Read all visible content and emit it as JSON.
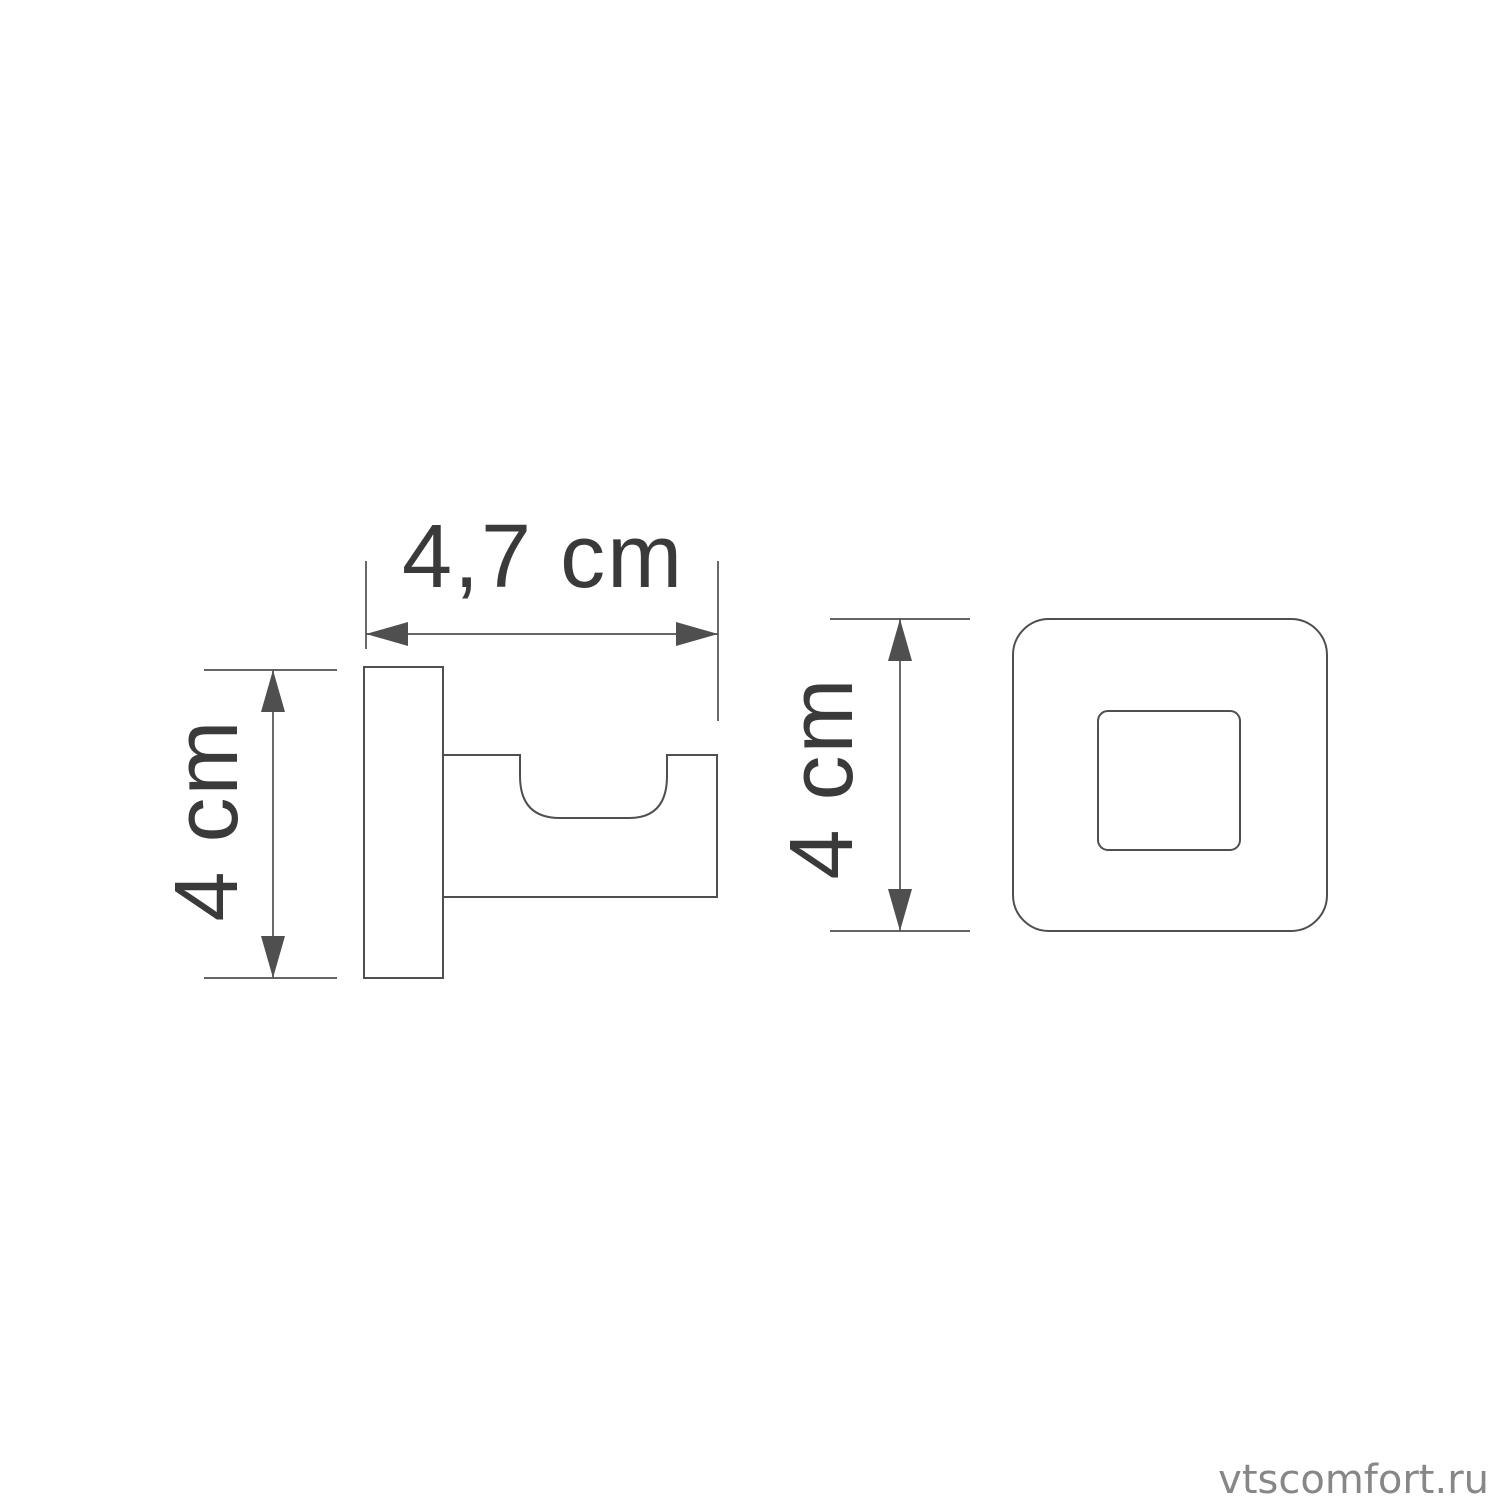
{
  "colors": {
    "background": "#ffffff",
    "line": "#4f4f4f",
    "text": "#3a3a3a",
    "watermark": "#878787"
  },
  "side_view": {
    "width_dimension_label": "4,7 cm",
    "height_dimension_label": "4 cm"
  },
  "front_view": {
    "height_dimension_label": "4 cm"
  },
  "watermark": {
    "text": "vtscomfort.ru"
  }
}
